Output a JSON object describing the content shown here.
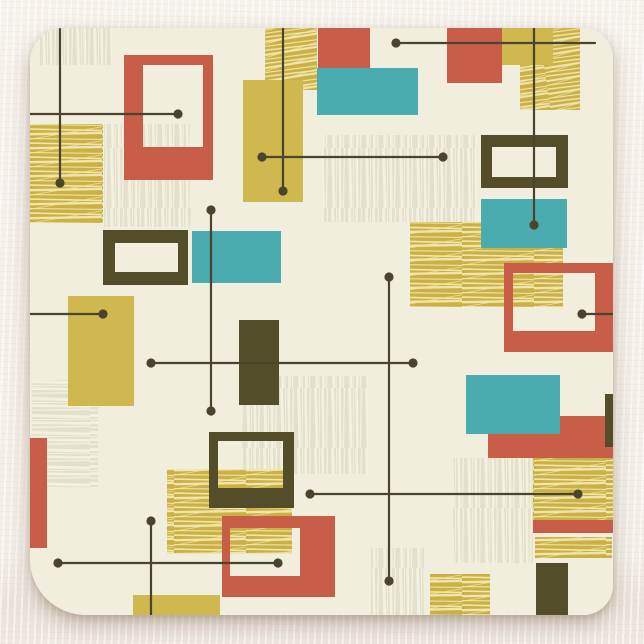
{
  "scene": {
    "description": "Product photo of a square paper coaster with a mid-century modern abstract pattern of rectangles, frames, hatched blocks and crosshair lines, lying on a textured white surface",
    "object": "square-coaster",
    "pattern_style": "mid-century-modern-atomic",
    "text_content": ""
  },
  "colors": {
    "surface": "#f3eee8",
    "coaster_base": "#f2eedd",
    "red": "#c85e47",
    "teal": "#4aacae",
    "mustard": "#cfb84e",
    "mustard_hatch_base": "#cbb142",
    "mustard_hatch_stroke": "#f0e5b0",
    "olive": "#544d29",
    "gray_hatch_base": "#e3e0cb",
    "gray_hatch_stroke": "#f4f1e1",
    "line": "#4a442e"
  },
  "pattern_inventory": {
    "solid_red_rects": 4,
    "red_frames": 3,
    "teal_rects": 4,
    "solid_mustard_rects": 4,
    "mustard_hatch_rects": 8,
    "gray_hatch_rects": 7,
    "olive_rects": 3,
    "olive_frames": 3,
    "crosshair_lines": 14,
    "line_end_dots": 20
  }
}
